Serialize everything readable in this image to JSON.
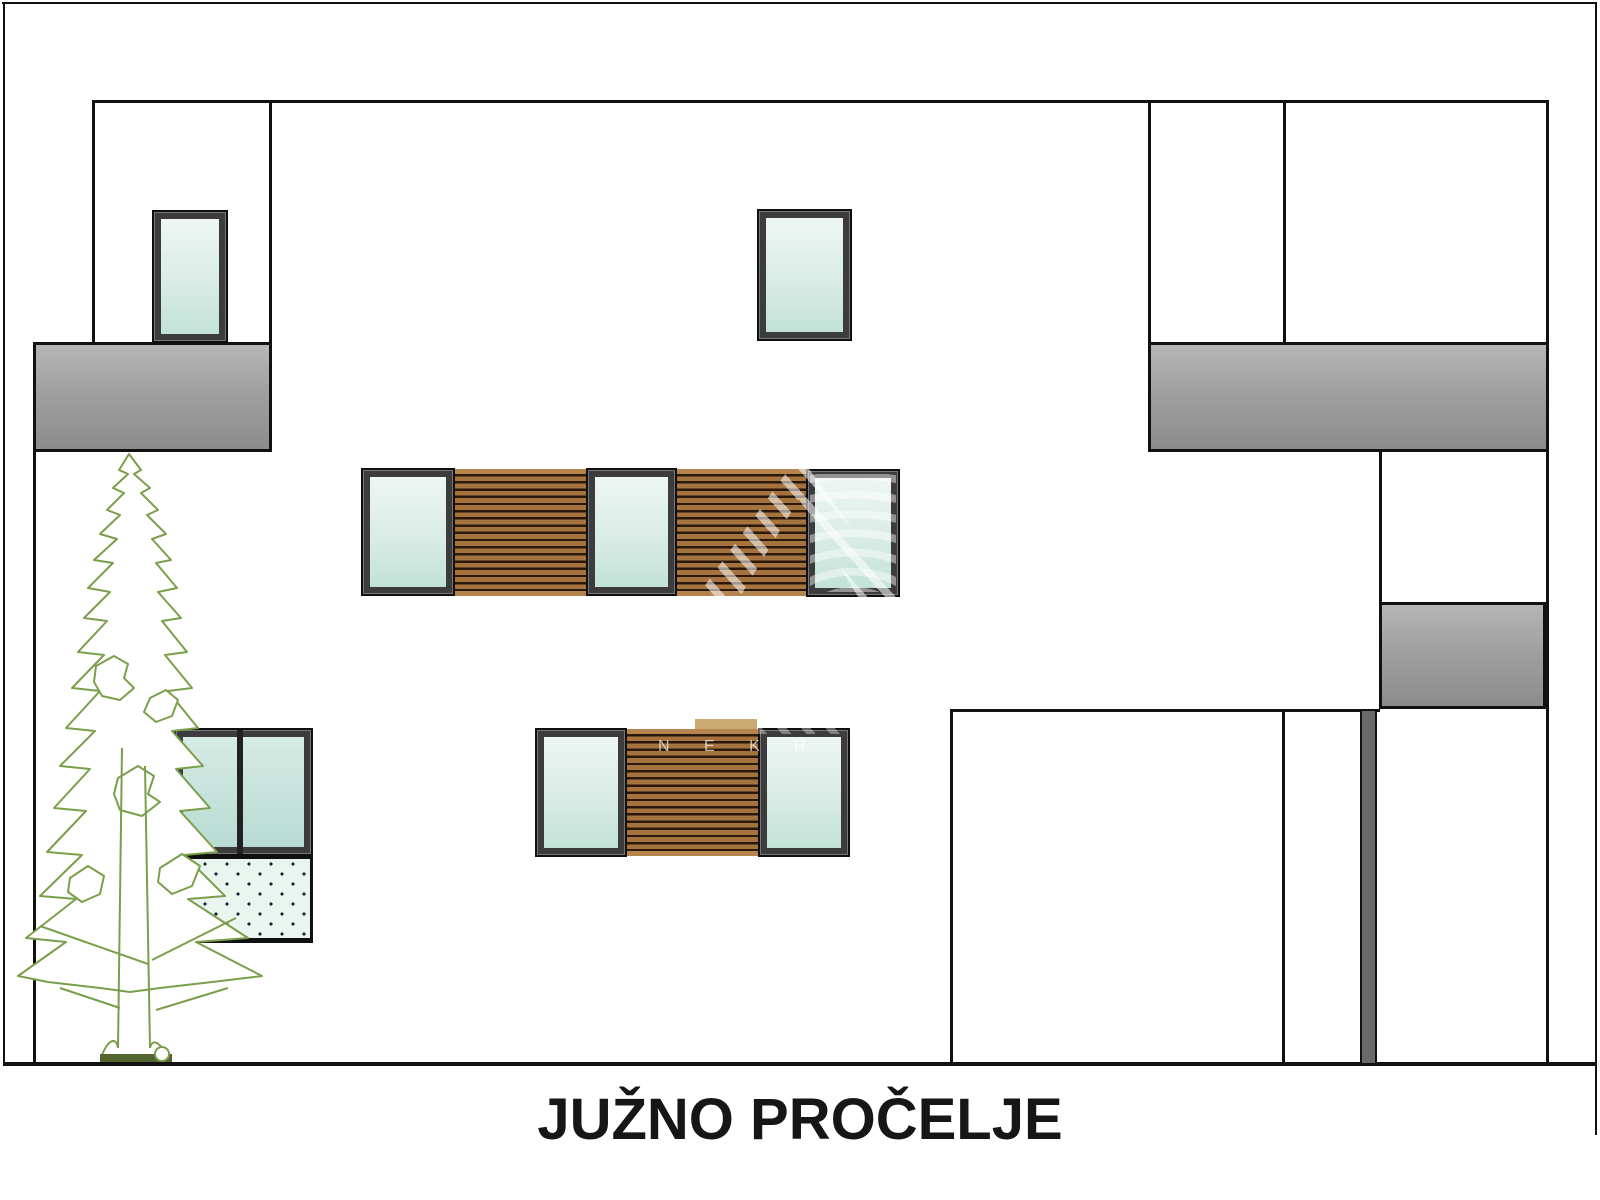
{
  "title": {
    "text": "JUŽNO PROČELJE"
  },
  "watermark": {
    "letters": "N E K R"
  },
  "colors": {
    "line_black": "#111111",
    "glass_top": "#eef6f2",
    "glass_bottom": "#c2e2d8",
    "wood_slat": "#a5743e",
    "wood_gap": "#2a180c",
    "balcony_gray_top": "#b6b6b6",
    "balcony_gray_bottom": "#8c8c8c",
    "pillar_gray": "#6a6a6a",
    "tree_green": "#7a9f4b",
    "terrace_dot_fill": "#eaf5f0"
  }
}
